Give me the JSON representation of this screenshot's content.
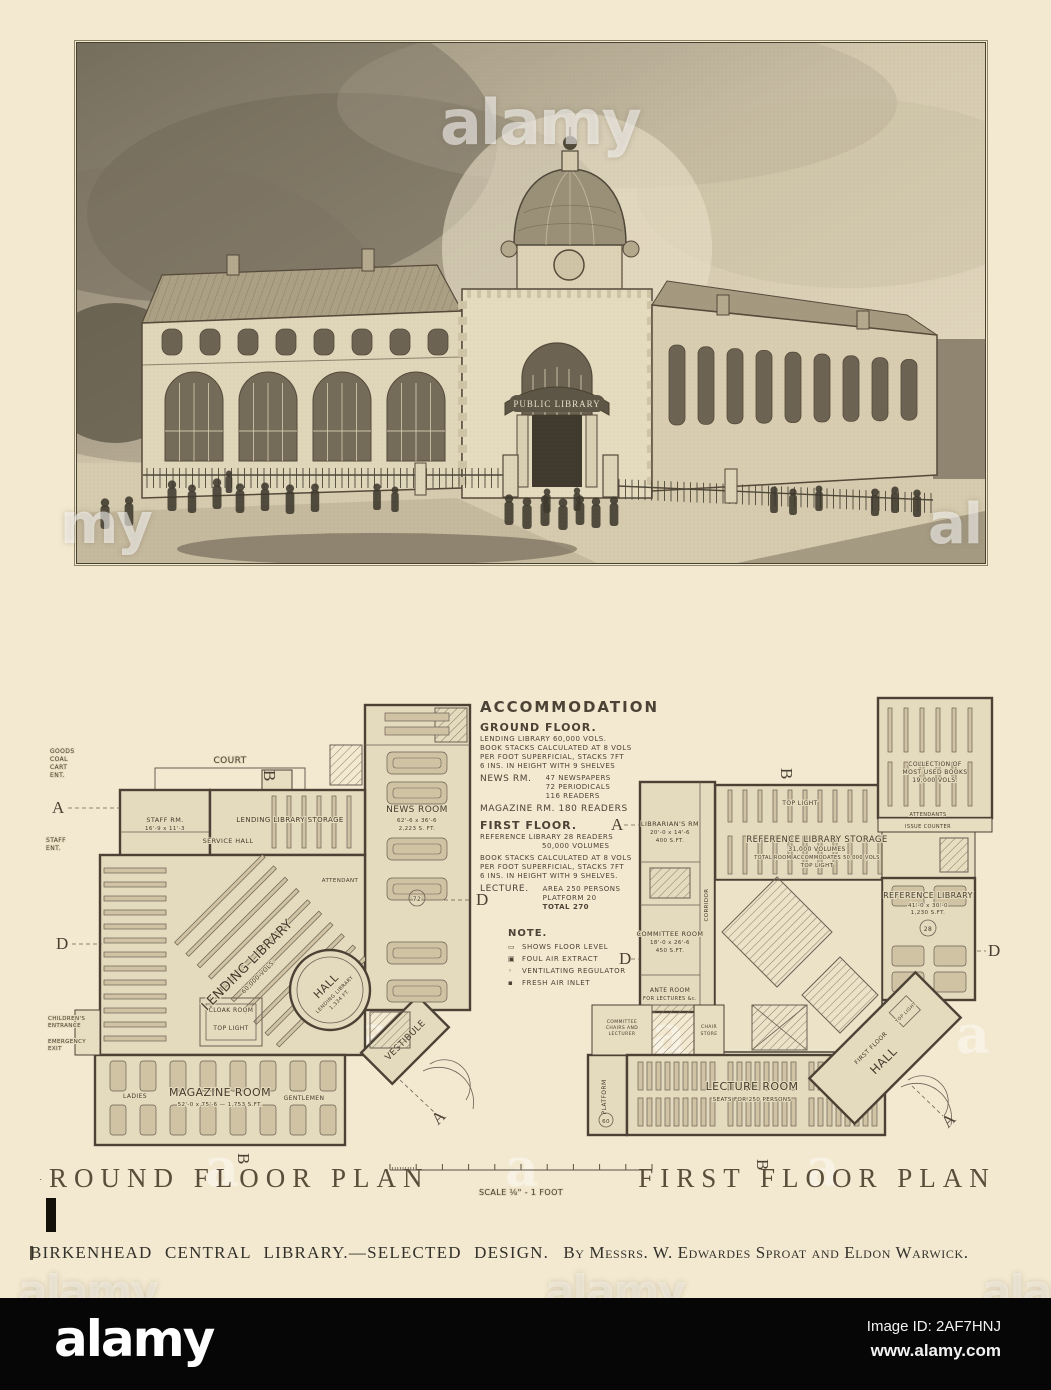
{
  "watermark": {
    "brand": "alamy",
    "partial_left": "my",
    "partial_right": "al",
    "ghost": "a",
    "image_id": "Image ID: 2AF7HNJ",
    "site": "www.alamy.com"
  },
  "photo": {
    "sign": "PUBLIC LIBRARY"
  },
  "accommodation": {
    "title": "ACCOMMODATION",
    "ground_heading": "GROUND FLOOR.",
    "ground_lines": [
      "LENDING LIBRARY 60,000 VOLS.",
      "BOOK STACKS CALCULATED AT 8 VOLS",
      "PER FOOT SUPERFICIAL, STACKS 7FT",
      "6 INS. IN HEIGHT WITH 9 SHELVES"
    ],
    "news_label": "NEWS RM.",
    "news_lines": [
      "47 NEWSPAPERS",
      "72 PERIODICALS",
      "116 READERS"
    ],
    "magazine_line": "MAGAZINE RM. 180 READERS",
    "first_heading": "FIRST FLOOR.",
    "first_lines": [
      "REFERENCE LIBRARY   28 READERS",
      "50,000 VOLUMES",
      "BOOK STACKS CALCULATED AT 8 VOLS",
      "PER FOOT SUPERFICIAL, STACKS 7FT",
      "6 INS. IN HEIGHT WITH 9 SHELVES."
    ],
    "lecture_label": "LECTURE.",
    "lecture_lines": [
      "AREA  250 PERSONS",
      "PLATFORM  20",
      "TOTAL  270"
    ]
  },
  "note": {
    "title": "NOTE.",
    "lines": [
      "SHOWS FLOOR LEVEL",
      "FOUL AIR EXTRACT",
      "VENTILATING REGULATOR",
      "FRESH AIR INLET"
    ]
  },
  "markers": {
    "a": "A",
    "b": "B",
    "d": "D"
  },
  "scale_label": "SCALE ⅛\" - 1 FOOT",
  "ground_plan": {
    "title": "GROUND FLOOR PLAN",
    "court": "COURT",
    "goods": [
      "GOODS",
      "COAL",
      "CART",
      "ENT."
    ],
    "staff_ent": [
      "STAFF",
      "ENT."
    ],
    "staff_rm": [
      "STAFF RM.",
      "16'-9 x 11'-3"
    ],
    "service_hall": "SERVICE HALL",
    "lending_storage": "LENDING LIBRARY STORAGE",
    "lending_library": [
      "LENDING LIBRARY",
      "60,000 VOLS."
    ],
    "childrens_entrance": [
      "CHILDREN'S",
      "ENTRANCE"
    ],
    "emergency_exit": [
      "EMERGENCY",
      "EXIT"
    ],
    "cloakroom": "CLOAK ROOM",
    "top_light": "TOP LIGHT",
    "hall": [
      "HALL",
      "LENDING LIBRARY",
      "1,334 FT."
    ],
    "vestibule": "VESTIBULE",
    "news_room": [
      "NEWS ROOM",
      "62'-6 x 36'-6",
      "2,223 S. FT."
    ],
    "news_readers": "72",
    "attendant": "ATTENDANT",
    "magazine": [
      "MAGAZINE ROOM",
      "52'-0 x 75'-6 — 1,753 S.FT."
    ],
    "ladies": "LADIES",
    "gentlemen": "GENTLEMEN"
  },
  "first_plan": {
    "title": "FIRST FLOOR PLAN",
    "librarians": [
      "LIBRARIAN'S RM",
      "20'-0 x 14'-6",
      "400 S.FT."
    ],
    "storage": [
      "REFERENCE LIBRARY STORAGE",
      "31,000 VOLUMES",
      "TOTAL ROOM ACCOMMODATES 50,000 VOLS",
      "TOP LIGHT"
    ],
    "top_light": "TOP LIGHT",
    "collection": [
      "COLLECTION OF",
      "MOST USED BOOKS",
      "19,000 VOLS."
    ],
    "attendants": "ATTENDANTS",
    "issue_counter": "ISSUE COUNTER",
    "reference": [
      "REFERENCE LIBRARY",
      "41'-0 x 30'-0",
      "1,230 S.FT."
    ],
    "ref_readers": "28",
    "committee": [
      "COMMITTEE ROOM",
      "18'-0 x 26'-6",
      "450 S.FT."
    ],
    "corridor": "CORRIDOR",
    "ante": [
      "ANTE ROOM",
      "FOR LECTURES &c."
    ],
    "chairs": [
      "COMMITTEE",
      "CHAIRS AND",
      "LECTURER"
    ],
    "chair_store": [
      "CHAIR",
      "STORE"
    ],
    "platform": "PLATFORM",
    "platform_no": "60",
    "lecture": [
      "LECTURE ROOM",
      "SEATS FOR 250 PERSONS"
    ],
    "hall": [
      "FIRST FLOOR",
      "HALL"
    ],
    "hall_top_light": "TOP LIGHT"
  },
  "caption": {
    "main": "BIRKENHEAD CENTRAL LIBRARY.—SELECTED DESIGN.",
    "by": "By Messrs. W. Edwardes Sproat and Eldon Warwick."
  }
}
